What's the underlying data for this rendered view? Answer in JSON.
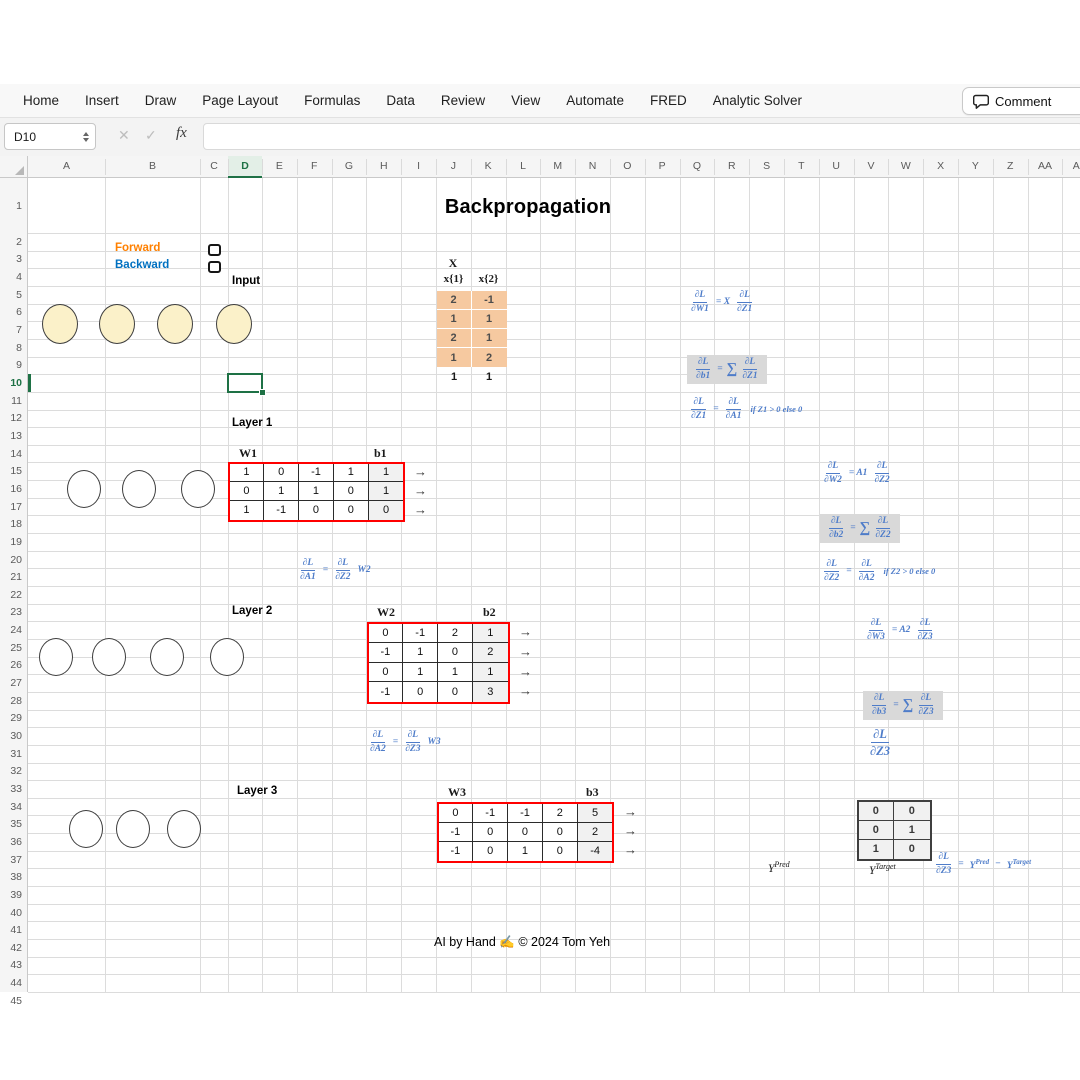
{
  "ribbon": {
    "tabs": [
      "Home",
      "Insert",
      "Draw",
      "Page Layout",
      "Formulas",
      "Data",
      "Review",
      "View",
      "Automate",
      "FRED",
      "Analytic Solver"
    ],
    "comment_label": "Comment"
  },
  "formula_bar": {
    "name_box": "D10",
    "cancel_icon": "✕",
    "accept_icon": "✓",
    "fx_label": "fx",
    "input_value": ""
  },
  "sheet": {
    "column_headers": [
      "A",
      "B",
      "C",
      "D",
      "E",
      "F",
      "G",
      "H",
      "I",
      "J",
      "K",
      "L",
      "M",
      "N",
      "O",
      "P",
      "Q",
      "R",
      "S",
      "T",
      "U",
      "V",
      "W",
      "X",
      "Y",
      "Z",
      "AA",
      "AB"
    ],
    "row_count": 45,
    "selected_cell": "D10",
    "selected_column": "D",
    "selected_row": 10,
    "title": "Backpropagation",
    "legend": {
      "forward": "Forward",
      "backward": "Backward"
    },
    "input_label": "Input",
    "arrow_icon": "→",
    "x_block": {
      "title": "X",
      "col_headers": [
        "x{1}",
        "x{2}"
      ],
      "shaded_rows": [
        [
          "2",
          "-1"
        ],
        [
          "1",
          "1"
        ],
        [
          "2",
          "1"
        ],
        [
          "1",
          "2"
        ]
      ],
      "plain_row": [
        "1",
        "1"
      ]
    },
    "neurons": {
      "input_count": 4,
      "layer_counts": [
        3,
        4,
        3
      ]
    },
    "layers": [
      {
        "label": "Layer 1",
        "w_label": "W1",
        "b_label": "b1",
        "rows": [
          [
            "1",
            "0",
            "-1",
            "1",
            "1"
          ],
          [
            "0",
            "1",
            "1",
            "0",
            "1"
          ],
          [
            "1",
            "-1",
            "0",
            "0",
            "0"
          ]
        ]
      },
      {
        "label": "Layer 2",
        "w_label": "W2",
        "b_label": "b2",
        "rows": [
          [
            "0",
            "-1",
            "2",
            "1"
          ],
          [
            "-1",
            "1",
            "0",
            "2"
          ],
          [
            "0",
            "1",
            "1",
            "1"
          ],
          [
            "-1",
            "0",
            "0",
            "3"
          ]
        ]
      },
      {
        "label": "Layer 3",
        "w_label": "W3",
        "b_label": "b3",
        "rows": [
          [
            "0",
            "-1",
            "-1",
            "2",
            "5"
          ],
          [
            "-1",
            "0",
            "0",
            "0",
            "2"
          ],
          [
            "-1",
            "0",
            "1",
            "0",
            "-4"
          ]
        ]
      }
    ],
    "y_pred": {
      "base": "Y",
      "sup": "Pred"
    },
    "y_target": {
      "base": "Y",
      "sup": "Target"
    },
    "target_table": [
      [
        "0",
        "0"
      ],
      [
        "0",
        "1"
      ],
      [
        "1",
        "0"
      ]
    ],
    "footer": "AI by Hand ✍ © 2024 Tom Yeh",
    "formulas": [
      {
        "id": "dL-dW1",
        "hl": false,
        "large": false,
        "parts": [
          {
            "t": "frac",
            "n": "∂L",
            "d": "∂W1"
          },
          {
            "t": "txt",
            "v": "= X"
          },
          {
            "t": "frac",
            "n": "∂L",
            "d": "∂Z1"
          }
        ]
      },
      {
        "id": "dL-db1",
        "hl": true,
        "large": false,
        "parts": [
          {
            "t": "frac",
            "n": "∂L",
            "d": "∂b1"
          },
          {
            "t": "txt",
            "v": "="
          },
          {
            "t": "sum"
          },
          {
            "t": "frac",
            "n": "∂L",
            "d": "∂Z1"
          }
        ]
      },
      {
        "id": "dL-dZ1",
        "hl": false,
        "large": false,
        "parts": [
          {
            "t": "frac",
            "n": "∂L",
            "d": "∂Z1"
          },
          {
            "t": "txt",
            "v": "="
          },
          {
            "t": "frac",
            "n": "∂L",
            "d": "∂A1"
          },
          {
            "t": "cond",
            "v": "if Z1 > 0 else 0"
          }
        ]
      },
      {
        "id": "dL-dA1",
        "hl": false,
        "large": false,
        "parts": [
          {
            "t": "frac",
            "n": "∂L",
            "d": "∂A1"
          },
          {
            "t": "txt",
            "v": "="
          },
          {
            "t": "frac",
            "n": "∂L",
            "d": "∂Z2"
          },
          {
            "t": "txt",
            "v": "W2"
          }
        ]
      },
      {
        "id": "dL-dW2",
        "hl": false,
        "large": false,
        "parts": [
          {
            "t": "frac",
            "n": "∂L",
            "d": "∂W2"
          },
          {
            "t": "txt",
            "v": "= A1"
          },
          {
            "t": "frac",
            "n": "∂L",
            "d": "∂Z2"
          }
        ]
      },
      {
        "id": "dL-db2",
        "hl": true,
        "large": false,
        "parts": [
          {
            "t": "frac",
            "n": "∂L",
            "d": "∂b2"
          },
          {
            "t": "txt",
            "v": "="
          },
          {
            "t": "sum"
          },
          {
            "t": "frac",
            "n": "∂L",
            "d": "∂Z2"
          }
        ]
      },
      {
        "id": "dL-dZ2",
        "hl": false,
        "large": false,
        "parts": [
          {
            "t": "frac",
            "n": "∂L",
            "d": "∂Z2"
          },
          {
            "t": "txt",
            "v": "="
          },
          {
            "t": "frac",
            "n": "∂L",
            "d": "∂A2"
          },
          {
            "t": "cond",
            "v": "if Z2 > 0 else 0"
          }
        ]
      },
      {
        "id": "dL-dA2",
        "hl": false,
        "large": false,
        "parts": [
          {
            "t": "frac",
            "n": "∂L",
            "d": "∂A2"
          },
          {
            "t": "txt",
            "v": "="
          },
          {
            "t": "frac",
            "n": "∂L",
            "d": "∂Z3"
          },
          {
            "t": "txt",
            "v": "W3"
          }
        ]
      },
      {
        "id": "dL-dW3",
        "hl": false,
        "large": false,
        "parts": [
          {
            "t": "frac",
            "n": "∂L",
            "d": "∂W3"
          },
          {
            "t": "txt",
            "v": "= A2"
          },
          {
            "t": "frac",
            "n": "∂L",
            "d": "∂Z3"
          }
        ]
      },
      {
        "id": "dL-db3",
        "hl": true,
        "large": false,
        "parts": [
          {
            "t": "frac",
            "n": "∂L",
            "d": "∂b3"
          },
          {
            "t": "txt",
            "v": "="
          },
          {
            "t": "sum"
          },
          {
            "t": "frac",
            "n": "∂L",
            "d": "∂Z3"
          }
        ]
      },
      {
        "id": "dL-dZ3",
        "hl": false,
        "large": true,
        "parts": [
          {
            "t": "frac",
            "n": "∂L",
            "d": "∂Z3"
          }
        ]
      },
      {
        "id": "dL-dZ3-eq",
        "hl": false,
        "large": false,
        "parts": [
          {
            "t": "frac",
            "n": "∂L",
            "d": "∂Z3"
          },
          {
            "t": "txt",
            "v": "="
          },
          {
            "t": "sup",
            "b": "Y",
            "s": "Pred"
          },
          {
            "t": "txt",
            "v": "−"
          },
          {
            "t": "sup",
            "b": "Y",
            "s": "Target"
          }
        ]
      }
    ],
    "colors": {
      "accent_green": "#1E7145",
      "formula_blue": "#4e7cc9",
      "forward_orange": "#FF8000",
      "backward_blue": "#0070C0",
      "table_orange": "#F6C9A0",
      "matrix_border_red": "#FF0000"
    }
  }
}
